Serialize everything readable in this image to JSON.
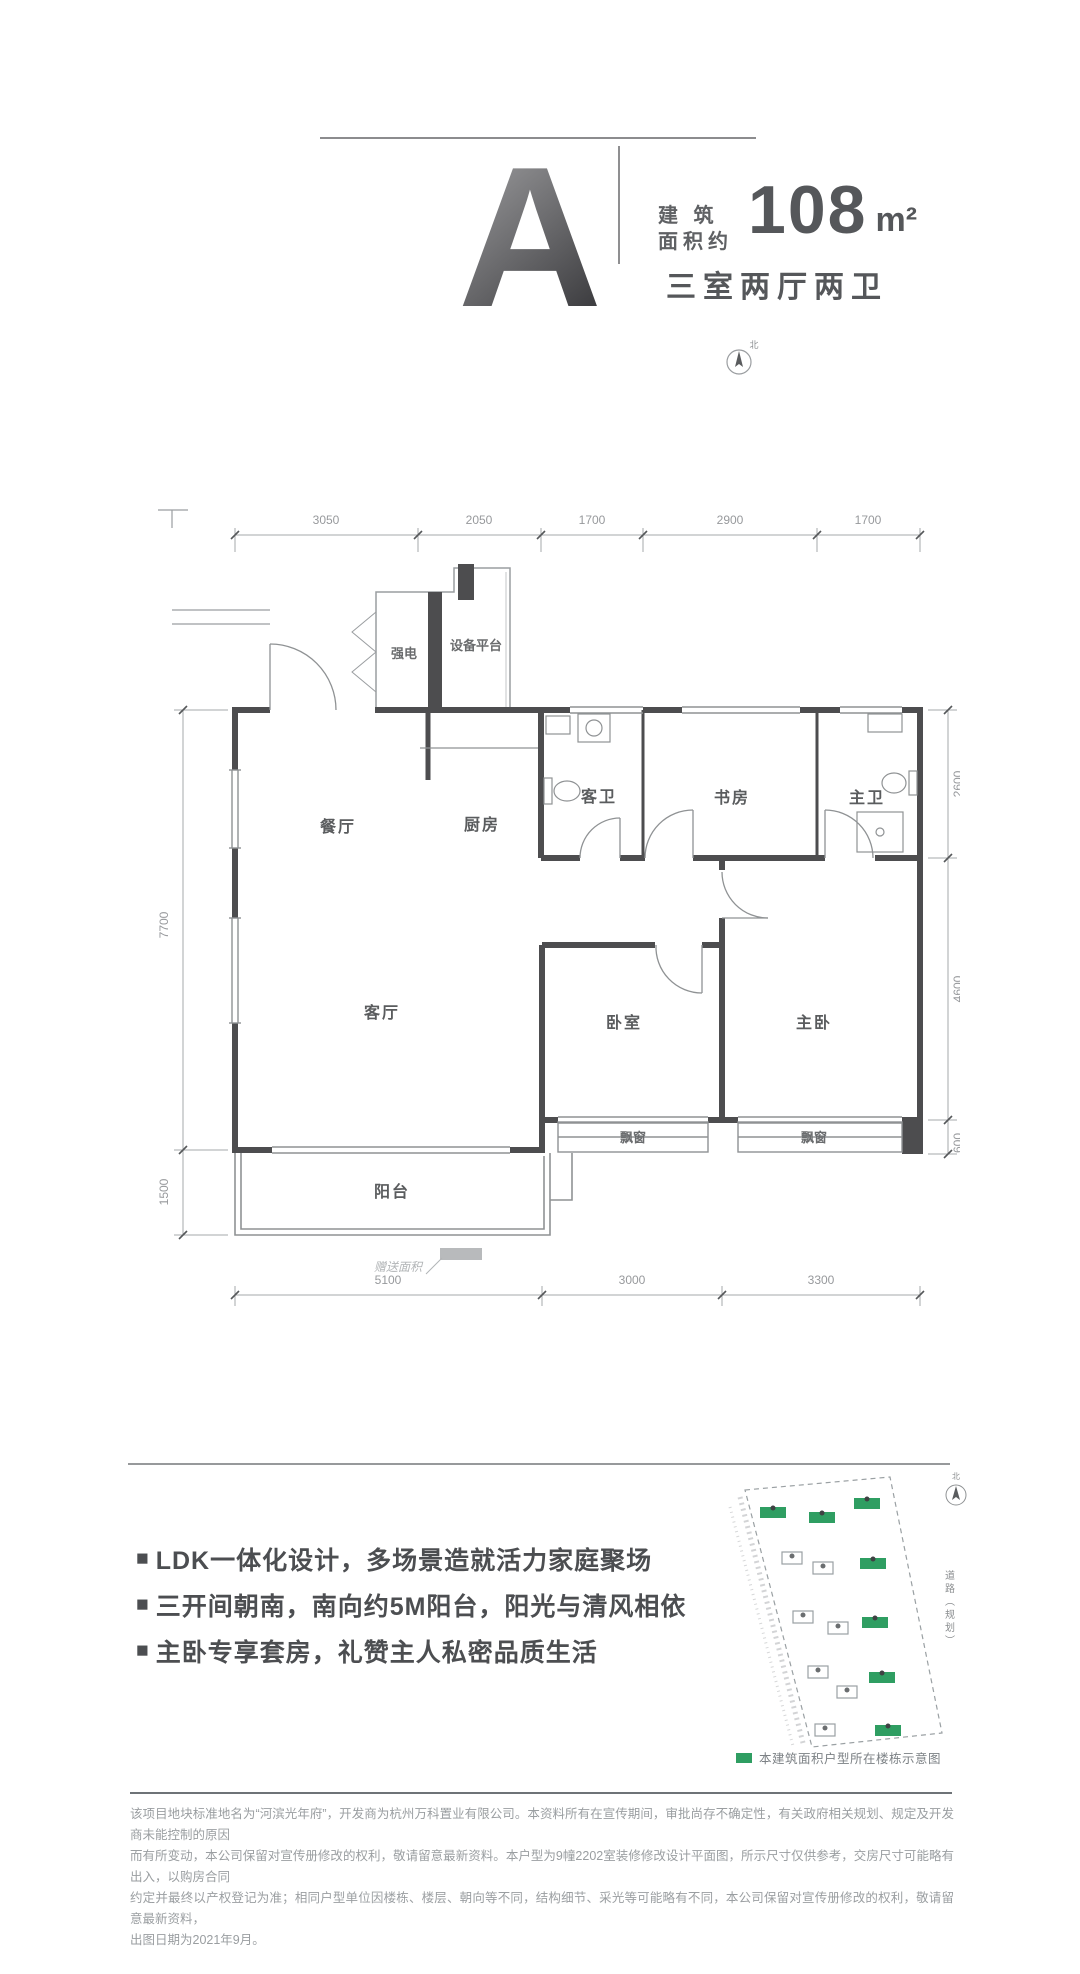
{
  "colors": {
    "accent_green": "#2f9e62",
    "wall_dark": "#4d4d4f",
    "dim_gray": "#9aa0a3",
    "text_dark": "#55575a"
  },
  "header": {
    "unit_letter": "A",
    "area_label_line1": "建 筑",
    "area_label_line2": "面积约",
    "area_value": "108",
    "area_unit": "m²",
    "layout_summary": "三室两厅两卫"
  },
  "floor_plan": {
    "rooms": {
      "dining": "餐厅",
      "kitchen": "厨房",
      "guest_bath": "客卫",
      "study": "书房",
      "master_bath": "主卫",
      "living": "客厅",
      "bedroom": "卧室",
      "master_bedroom": "主卧",
      "balcony": "阳台",
      "bay_window_left": "飘窗",
      "bay_window_right": "飘窗",
      "strong_electric": "强电",
      "equipment_platform": "设备平台",
      "bonus_area_note": "赠送面积"
    },
    "dims_top": [
      "3050",
      "2050",
      "1700",
      "2900",
      "1700"
    ],
    "dims_bottom": [
      "5100",
      "3000",
      "3300"
    ],
    "dims_left": [
      "7700",
      "1500"
    ],
    "dims_right": [
      "2600",
      "4600",
      "600"
    ],
    "compass_label": "北"
  },
  "features": {
    "marker": "■",
    "items": [
      "LDK一体化设计，多场景造就活力家庭聚场",
      "三开间朝南，南向约5M阳台，阳光与清风相依",
      "主卧专享套房，礼赞主人私密品质生活"
    ]
  },
  "site_map": {
    "road_label": "道路（规划）",
    "compass_label": "北",
    "legend_text": "本建筑面积户型所在楼栋示意图"
  },
  "disclaimer": {
    "lines": [
      "该项目地块标准地名为“河滨光年府”，开发商为杭州万科置业有限公司。本资料所有在宣传期间，审批尚存不确定性，有关政府相关规划、规定及开发商未能控制的原因",
      "而有所变动，本公司保留对宣传册修改的权利，敬请留意最新资料。本户型为9幢2202室装修修改设计平面图，所示尺寸仅供参考，交房尺寸可能略有出入，以购房合同",
      "约定并最终以产权登记为准；相同户型单位因楼栋、楼层、朝向等不同，结构细节、采光等可能略有不同，本公司保留对宣传册修改的权利，敬请留意最新资料，",
      "出图日期为2021年9月。"
    ]
  }
}
